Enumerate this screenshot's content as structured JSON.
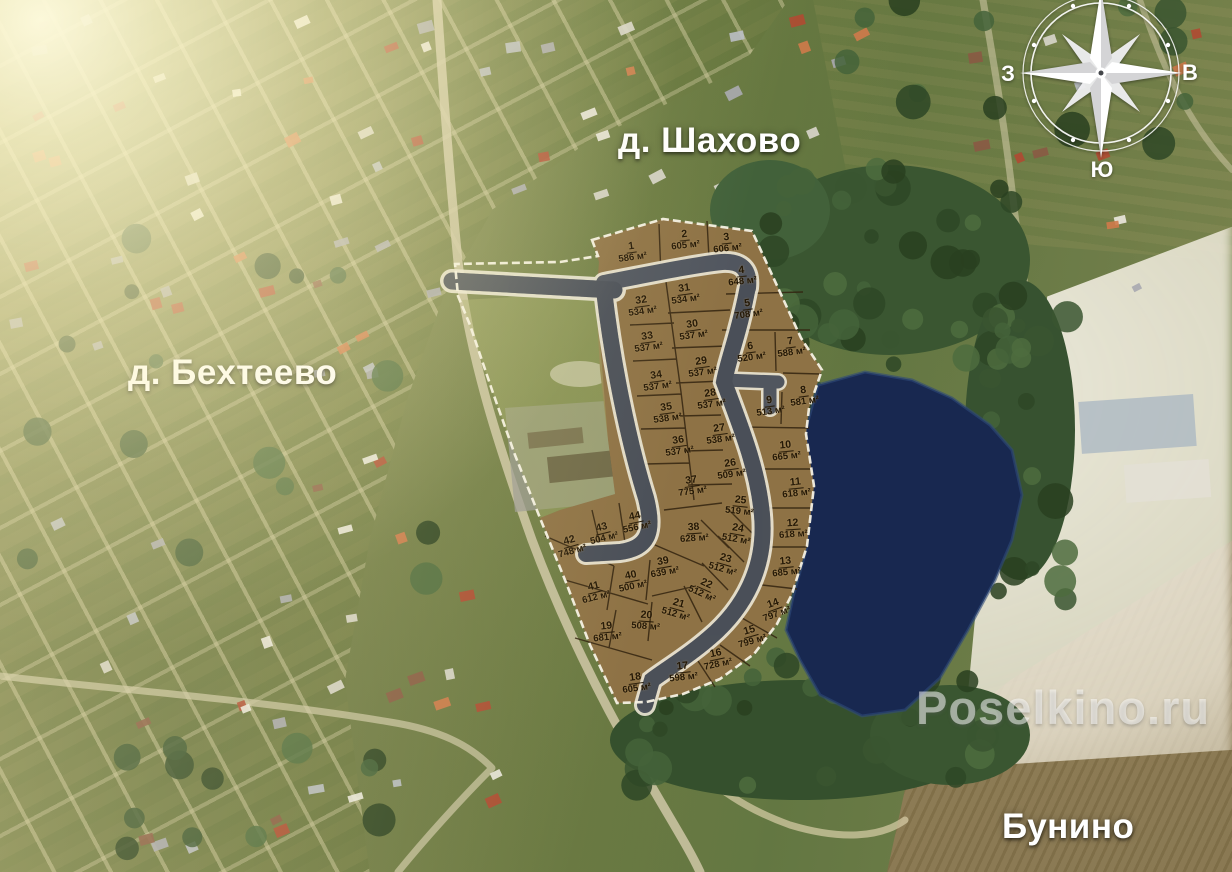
{
  "map": {
    "labels": {
      "shahovo": "д. Шахово",
      "bekhteevo": "д. Бехтеево",
      "bunino": "Бунино"
    },
    "watermark": "Poselkino.ru",
    "compass": {
      "west": "З",
      "east": "В",
      "south": "Ю"
    },
    "unit": "м²",
    "colors": {
      "plot_fill": "#8e7245",
      "plot_line": "#32230f",
      "road": "#51565f",
      "boundary": "#f5f1e4",
      "pond": "#182850",
      "forest": "#3a5530",
      "field": "#8d7b52"
    },
    "plots": [
      {
        "n": 1,
        "area": 586,
        "x": 632,
        "y": 252,
        "r": -8
      },
      {
        "n": 2,
        "area": 605,
        "x": 685,
        "y": 240,
        "r": -6
      },
      {
        "n": 3,
        "area": 606,
        "x": 727,
        "y": 243,
        "r": -6
      },
      {
        "n": 4,
        "area": 648,
        "x": 742,
        "y": 276,
        "r": -6
      },
      {
        "n": 5,
        "area": 708,
        "x": 748,
        "y": 309,
        "r": -8
      },
      {
        "n": 6,
        "area": 520,
        "x": 751,
        "y": 352,
        "r": -8
      },
      {
        "n": 7,
        "area": 588,
        "x": 791,
        "y": 347,
        "r": -8
      },
      {
        "n": 8,
        "area": 581,
        "x": 804,
        "y": 396,
        "r": -8
      },
      {
        "n": 9,
        "area": 513,
        "x": 770,
        "y": 406,
        "r": -8
      },
      {
        "n": 10,
        "area": 665,
        "x": 786,
        "y": 451,
        "r": -6
      },
      {
        "n": 11,
        "area": 618,
        "x": 796,
        "y": 488,
        "r": -6
      },
      {
        "n": 12,
        "area": 618,
        "x": 793,
        "y": 529,
        "r": -4
      },
      {
        "n": 13,
        "area": 685,
        "x": 786,
        "y": 567,
        "r": -6
      },
      {
        "n": 14,
        "area": 797,
        "x": 775,
        "y": 609,
        "r": -20
      },
      {
        "n": 15,
        "area": 799,
        "x": 751,
        "y": 636,
        "r": -16
      },
      {
        "n": 16,
        "area": 728,
        "x": 717,
        "y": 659,
        "r": -12
      },
      {
        "n": 17,
        "area": 598,
        "x": 683,
        "y": 672,
        "r": -6
      },
      {
        "n": 18,
        "area": 605,
        "x": 636,
        "y": 683,
        "r": -8
      },
      {
        "n": 19,
        "area": 681,
        "x": 607,
        "y": 632,
        "r": -6
      },
      {
        "n": 20,
        "area": 508,
        "x": 646,
        "y": 621,
        "r": 4
      },
      {
        "n": 21,
        "area": 512,
        "x": 677,
        "y": 609,
        "r": 16
      },
      {
        "n": 22,
        "area": 512,
        "x": 704,
        "y": 589,
        "r": 24
      },
      {
        "n": 23,
        "area": 512,
        "x": 724,
        "y": 564,
        "r": 16
      },
      {
        "n": 24,
        "area": 512,
        "x": 737,
        "y": 534,
        "r": 10
      },
      {
        "n": 25,
        "area": 519,
        "x": 740,
        "y": 506,
        "r": 6
      },
      {
        "n": 26,
        "area": 509,
        "x": 731,
        "y": 469,
        "r": -8
      },
      {
        "n": 27,
        "area": 538,
        "x": 720,
        "y": 434,
        "r": -8
      },
      {
        "n": 28,
        "area": 537,
        "x": 711,
        "y": 399,
        "r": -8
      },
      {
        "n": 29,
        "area": 537,
        "x": 702,
        "y": 367,
        "r": -8
      },
      {
        "n": 30,
        "area": 537,
        "x": 693,
        "y": 330,
        "r": -8
      },
      {
        "n": 31,
        "area": 534,
        "x": 685,
        "y": 294,
        "r": -8
      },
      {
        "n": 32,
        "area": 534,
        "x": 642,
        "y": 306,
        "r": -8
      },
      {
        "n": 33,
        "area": 537,
        "x": 648,
        "y": 342,
        "r": -8
      },
      {
        "n": 34,
        "area": 537,
        "x": 657,
        "y": 381,
        "r": -8
      },
      {
        "n": 35,
        "area": 538,
        "x": 667,
        "y": 413,
        "r": -8
      },
      {
        "n": 36,
        "area": 537,
        "x": 679,
        "y": 446,
        "r": -8
      },
      {
        "n": 37,
        "area": 775,
        "x": 692,
        "y": 486,
        "r": -8
      },
      {
        "n": 38,
        "area": 628,
        "x": 694,
        "y": 533,
        "r": -4
      },
      {
        "n": 39,
        "area": 639,
        "x": 664,
        "y": 567,
        "r": -10
      },
      {
        "n": 40,
        "area": 500,
        "x": 632,
        "y": 581,
        "r": -12
      },
      {
        "n": 41,
        "area": 612,
        "x": 595,
        "y": 592,
        "r": -14
      },
      {
        "n": 42,
        "area": 748,
        "x": 571,
        "y": 546,
        "r": -16
      },
      {
        "n": 43,
        "area": 504,
        "x": 603,
        "y": 533,
        "r": -14
      },
      {
        "n": 44,
        "area": 556,
        "x": 636,
        "y": 522,
        "r": -12
      }
    ]
  }
}
